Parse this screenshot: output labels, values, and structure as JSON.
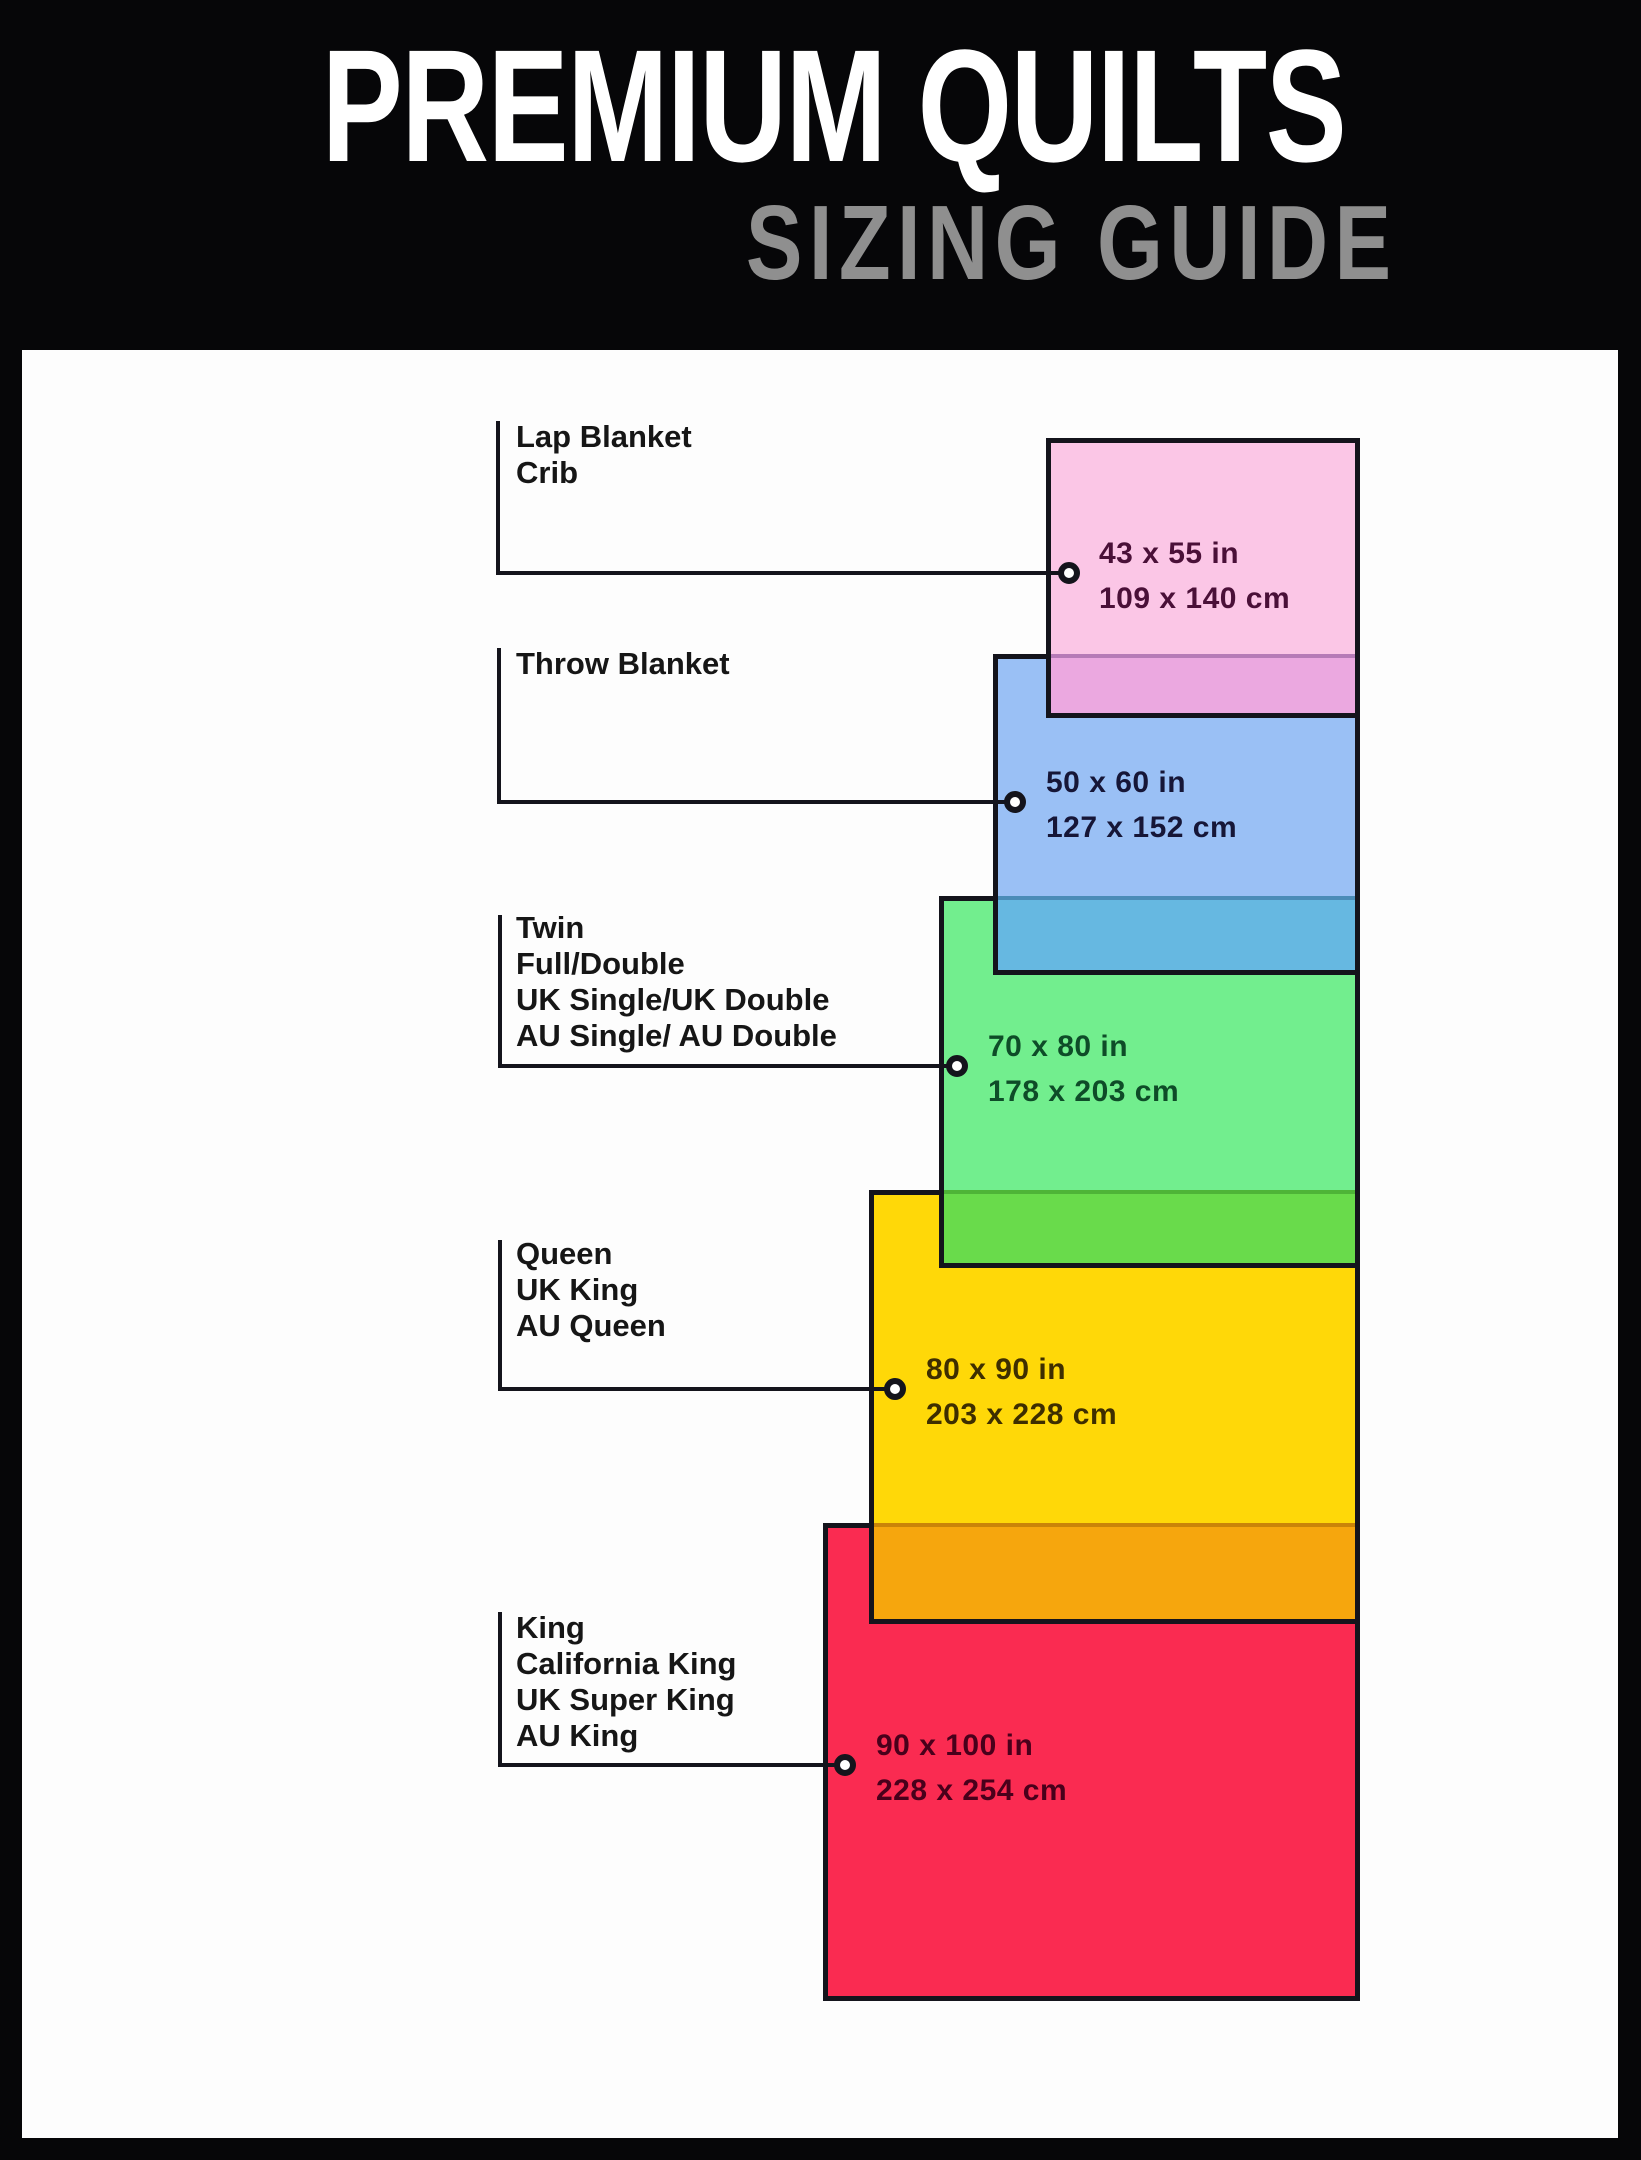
{
  "header": {
    "title": "PREMIUM QUILTS",
    "subtitle": "SIZING GUIDE"
  },
  "sizes": [
    {
      "id": "lap-crib",
      "names": [
        "Lap Blanket",
        "Crib"
      ],
      "inches": "43 x 55 in",
      "cm": "109 x 140 cm",
      "fill": "#FBC6E6",
      "overlap_fill": "#EBA8E0",
      "dims_text_color": "#4A1038"
    },
    {
      "id": "throw",
      "names": [
        "Throw Blanket"
      ],
      "inches": "50 x 60 in",
      "cm": "127 x 152 cm",
      "fill": "#9AC0F5",
      "overlap_fill": "#66B8E1",
      "dims_text_color": "#161637"
    },
    {
      "id": "twin",
      "names": [
        "Twin",
        "Full/Double",
        "UK Single/UK Double",
        "AU Single/ AU Double"
      ],
      "inches": "70 x 80 in",
      "cm": "178 x 203 cm",
      "fill": "#72EE8E",
      "overlap_fill": "#69DB4B",
      "dims_text_color": "#0E4C28"
    },
    {
      "id": "queen",
      "names": [
        "Queen",
        "UK King",
        "AU Queen"
      ],
      "inches": "80 x 90 in",
      "cm": "203 x 228 cm",
      "fill": "#FFD808",
      "overlap_fill": "#F6A60D",
      "dims_text_color": "#3E2E00"
    },
    {
      "id": "king",
      "names": [
        "King",
        "California King",
        "UK Super King",
        "AU King"
      ],
      "inches": "90 x 100 in",
      "cm": "228 x 254 cm",
      "fill": "#FA2B51",
      "overlap_fill": null,
      "dims_text_color": "#49001B"
    }
  ],
  "colors": {
    "page_background": "#060608",
    "content_background": "#FDFDFD",
    "rect_border": "#14141C",
    "leader_line": "#14141C",
    "title": "#FFFFFF",
    "subtitle": "#8F8F8F",
    "label_text": "#161616",
    "marker_fill": "#FFFFFF"
  }
}
